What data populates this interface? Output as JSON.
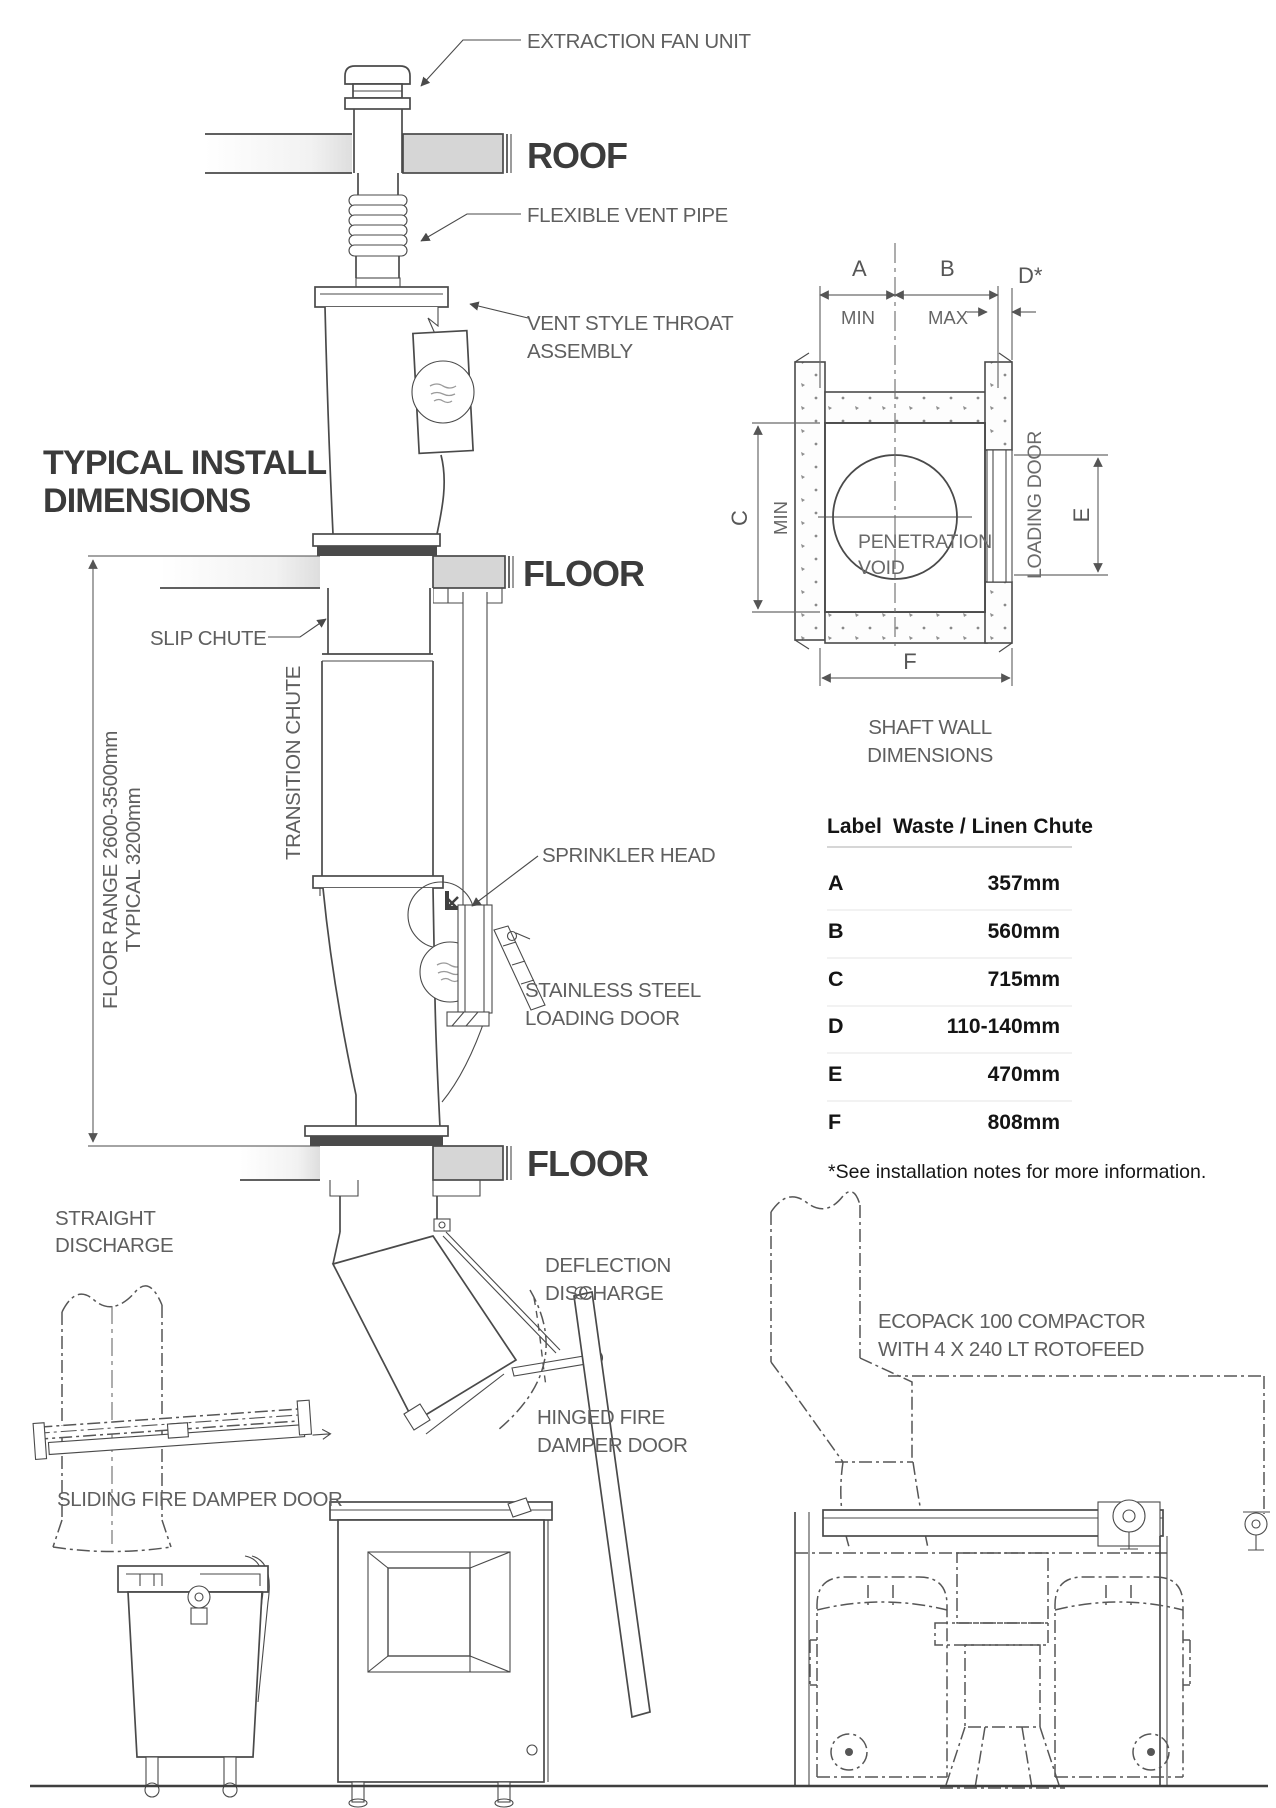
{
  "colors": {
    "background": "#ffffff",
    "line": "#4a4a4a",
    "label_gray": "#5f5f5f",
    "slab_gray": "#d6d6d6",
    "flange_dark": "#4a4a4a"
  },
  "heading": {
    "line1": "TYPICAL INSTALL",
    "line2": "DIMENSIONS"
  },
  "callouts": {
    "extraction_fan_unit": "EXTRACTION FAN UNIT",
    "roof": "ROOF",
    "flexible_vent_pipe": "FLEXIBLE VENT PIPE",
    "vent_throat_1": "VENT STYLE THROAT",
    "vent_throat_2": "ASSEMBLY",
    "floor_1": "FLOOR",
    "slip_chute": "SLIP CHUTE",
    "transition_chute": "TRANSITION CHUTE",
    "height_dim_1": "TYPICAL 3200mm",
    "height_dim_2": "FLOOR RANGE 2600-3500mm",
    "sprinkler_head": "SPRINKLER HEAD",
    "stainless_1": "STAINLESS STEEL",
    "stainless_2": "LOADING DOOR",
    "floor_2": "FLOOR",
    "straight_1": "STRAIGHT",
    "straight_2": "DISCHARGE",
    "deflection_1": "DEFLECTION",
    "deflection_2": "DISCHARGE",
    "hinged_1": "HINGED FIRE",
    "hinged_2": "DAMPER DOOR",
    "sliding": "SLIDING FIRE DAMPER DOOR",
    "ecopack_1": "ECOPACK 100 COMPACTOR",
    "ecopack_2": "WITH 4 X 240 LT ROTOFEED"
  },
  "shaft": {
    "a": "A",
    "b": "B",
    "c": "C",
    "d": "D*",
    "e": "E",
    "f": "F",
    "min_top": "MIN",
    "max_top": "MAX",
    "min_left": "MIN",
    "void_1": "PENETRATION",
    "void_2": "VOID",
    "loading_door": "LOADING DOOR",
    "caption_1": "SHAFT WALL",
    "caption_2": "DIMENSIONS"
  },
  "table": {
    "col_label": "Label",
    "col_value": "Waste / Linen Chute",
    "rows": [
      {
        "label": "A",
        "value": "357mm"
      },
      {
        "label": "B",
        "value": "560mm"
      },
      {
        "label": "C",
        "value": "715mm"
      },
      {
        "label": "D",
        "value": "110-140mm"
      },
      {
        "label": "E",
        "value": "470mm"
      },
      {
        "label": "F",
        "value": "808mm"
      }
    ],
    "note": "*See installation notes for more information."
  }
}
